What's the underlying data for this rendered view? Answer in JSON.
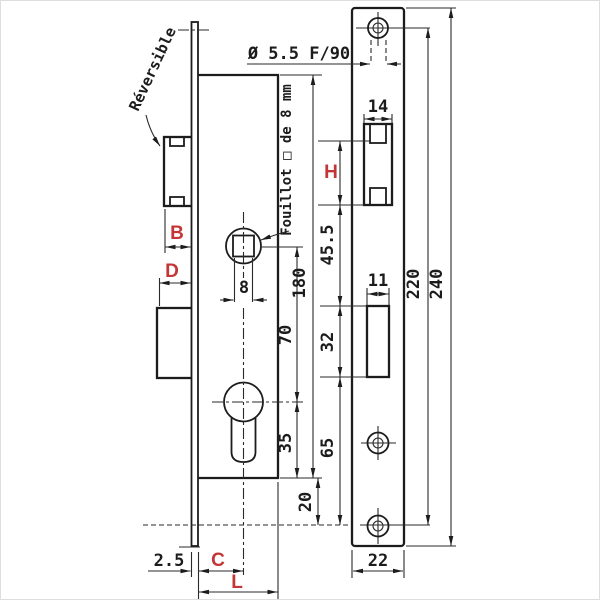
{
  "side_view": {
    "labels": {
      "reversible": "Réversible",
      "fouillot": "Fouillot □ de 8 mm"
    },
    "dims": {
      "square": "8",
      "follower_to_cylinder": "70",
      "cylinder_to_bottom": "35",
      "case_height": "180",
      "bottom_offset": "20",
      "plate_thickness": "2.5"
    },
    "red": {
      "latch_throw": "B",
      "deadbolt_throw": "D",
      "backset": "C",
      "case_depth": "L"
    }
  },
  "front_view": {
    "dims": {
      "hole_spec": "Ø 5.5 F/90",
      "latch_cutout_width": "14",
      "latch_to_deadbolt": "45.5",
      "deadbolt_cutout_height": "32",
      "deadbolt_cutout_width": "11",
      "deadbolt_to_hole": "65",
      "hole_spacing": "220",
      "plate_height": "240",
      "plate_width": "22"
    },
    "red": {
      "latch_cutout_height": "H"
    }
  },
  "colors": {
    "line": "#1c1c1c",
    "red": "#c43535",
    "background": "#ffffff"
  }
}
